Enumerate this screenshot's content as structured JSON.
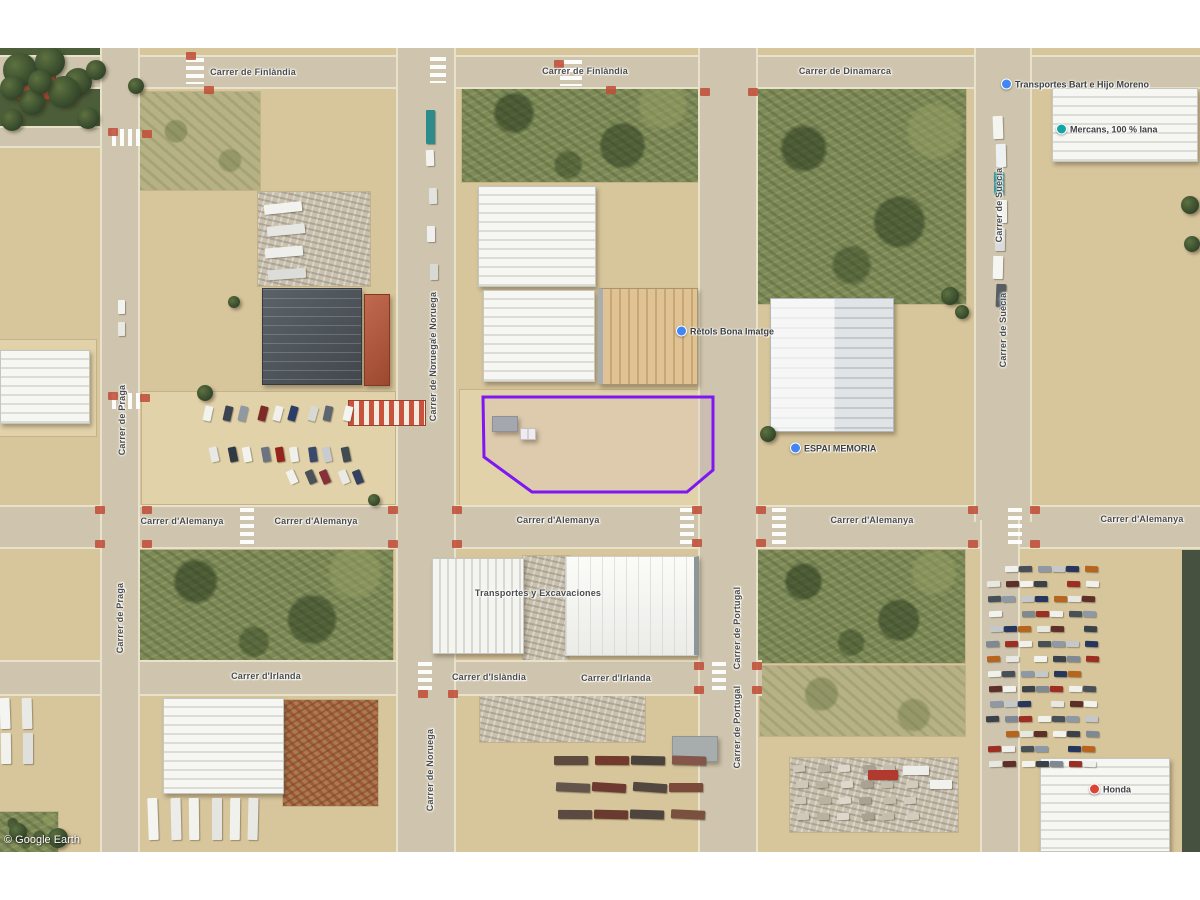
{
  "meta": {
    "watermark": "© Google Earth"
  },
  "map": {
    "x": 0,
    "y": 48,
    "w": 1200,
    "h": 804,
    "letterbox_color": "#ffffff",
    "base_color": "#d7c59c"
  },
  "parcel": {
    "stroke": "#7e17f2",
    "fill": "rgba(126,23,242,0.04)",
    "points": [
      [
        483,
        397
      ],
      [
        713,
        397
      ],
      [
        713,
        470
      ],
      [
        687,
        492
      ],
      [
        532,
        492
      ],
      [
        484,
        457
      ]
    ]
  },
  "terrain": [
    {
      "kind": "treesbed",
      "x": 0,
      "y": 48,
      "w": 104,
      "h": 92
    },
    {
      "kind": "scrublight",
      "x": 140,
      "y": 92,
      "w": 120,
      "h": 98
    },
    {
      "kind": "scrub",
      "x": 462,
      "y": 86,
      "w": 236,
      "h": 96
    },
    {
      "kind": "scrub",
      "x": 758,
      "y": 88,
      "w": 208,
      "h": 216
    },
    {
      "kind": "scrub",
      "x": 140,
      "y": 550,
      "w": 253,
      "h": 112
    },
    {
      "kind": "scrub",
      "x": 758,
      "y": 550,
      "w": 207,
      "h": 113
    },
    {
      "kind": "scrublight",
      "x": 760,
      "y": 666,
      "w": 205,
      "h": 70
    },
    {
      "kind": "pale",
      "x": 142,
      "y": 392,
      "w": 253,
      "h": 112
    },
    {
      "kind": "pale",
      "x": 460,
      "y": 390,
      "w": 262,
      "h": 116
    },
    {
      "kind": "pale",
      "x": 0,
      "y": 340,
      "w": 96,
      "h": 96
    },
    {
      "kind": "darkstrip",
      "x": 1182,
      "y": 550,
      "w": 18,
      "h": 302
    },
    {
      "kind": "scrub",
      "x": 0,
      "y": 812,
      "w": 58,
      "h": 40
    },
    {
      "kind": "clutter",
      "x": 480,
      "y": 690,
      "w": 165,
      "h": 52
    },
    {
      "kind": "clutter",
      "x": 790,
      "y": 758,
      "w": 168,
      "h": 74
    },
    {
      "kind": "rust",
      "x": 283,
      "y": 700,
      "w": 95,
      "h": 106
    },
    {
      "kind": "clutter",
      "x": 523,
      "y": 556,
      "w": 46,
      "h": 104
    },
    {
      "kind": "clutter",
      "x": 258,
      "y": 192,
      "w": 112,
      "h": 94
    }
  ],
  "roads": [
    {
      "x": 0,
      "y": 55,
      "w": 1200,
      "h": 34
    },
    {
      "x": 0,
      "y": 505,
      "w": 1200,
      "h": 44
    },
    {
      "x": 0,
      "y": 660,
      "w": 762,
      "h": 36
    },
    {
      "x": 0,
      "y": 126,
      "w": 140,
      "h": 22
    },
    {
      "x": 100,
      "y": 48,
      "w": 40,
      "h": 804
    },
    {
      "x": 396,
      "y": 48,
      "w": 60,
      "h": 804
    },
    {
      "x": 698,
      "y": 48,
      "w": 60,
      "h": 804
    },
    {
      "x": 974,
      "y": 48,
      "w": 58,
      "h": 474
    },
    {
      "x": 980,
      "y": 520,
      "w": 40,
      "h": 332
    }
  ],
  "crosswalks": [
    {
      "x": 186,
      "y": 58,
      "w": 18,
      "h": 26,
      "dir": "v"
    },
    {
      "x": 560,
      "y": 60,
      "w": 22,
      "h": 26,
      "dir": "v"
    },
    {
      "x": 430,
      "y": 57,
      "w": 16,
      "h": 26,
      "dir": "v"
    },
    {
      "x": 112,
      "y": 129,
      "w": 30,
      "h": 17,
      "dir": "h"
    },
    {
      "x": 112,
      "y": 393,
      "w": 30,
      "h": 16,
      "dir": "h"
    },
    {
      "x": 240,
      "y": 508,
      "w": 14,
      "h": 38,
      "dir": "v"
    },
    {
      "x": 680,
      "y": 508,
      "w": 14,
      "h": 38,
      "dir": "v"
    },
    {
      "x": 772,
      "y": 508,
      "w": 14,
      "h": 38,
      "dir": "v"
    },
    {
      "x": 1008,
      "y": 508,
      "w": 14,
      "h": 38,
      "dir": "v"
    },
    {
      "x": 418,
      "y": 662,
      "w": 14,
      "h": 32,
      "dir": "v"
    },
    {
      "x": 712,
      "y": 662,
      "w": 14,
      "h": 32,
      "dir": "v"
    }
  ],
  "barrier": {
    "x": 348,
    "y": 400,
    "w": 78,
    "h": 26
  },
  "ramps": [
    [
      95,
      506
    ],
    [
      95,
      540
    ],
    [
      142,
      506
    ],
    [
      142,
      540
    ],
    [
      388,
      506
    ],
    [
      388,
      540
    ],
    [
      452,
      506
    ],
    [
      452,
      540
    ],
    [
      692,
      506
    ],
    [
      692,
      539
    ],
    [
      756,
      506
    ],
    [
      756,
      539
    ],
    [
      968,
      506
    ],
    [
      968,
      540
    ],
    [
      1030,
      506
    ],
    [
      1030,
      540
    ],
    [
      694,
      662
    ],
    [
      694,
      686
    ],
    [
      752,
      662
    ],
    [
      752,
      686
    ],
    [
      418,
      690
    ],
    [
      448,
      690
    ],
    [
      108,
      128
    ],
    [
      142,
      130
    ],
    [
      108,
      392
    ],
    [
      140,
      394
    ],
    [
      186,
      52
    ],
    [
      204,
      86
    ],
    [
      554,
      60
    ],
    [
      606,
      86
    ],
    [
      700,
      88
    ],
    [
      748,
      88
    ]
  ],
  "buildings": [
    {
      "name": "house-red-roof",
      "x": 16,
      "y": 62,
      "w": 40,
      "h": 38,
      "style": "red-roof"
    },
    {
      "name": "warehouse",
      "x": 0,
      "y": 350,
      "w": 90,
      "h": 74,
      "style": "white-h"
    },
    {
      "name": "warehouse-dark",
      "x": 262,
      "y": 288,
      "w": 100,
      "h": 97,
      "style": "dark"
    },
    {
      "name": "building-red",
      "x": 364,
      "y": 294,
      "w": 26,
      "h": 92,
      "style": "red-roof"
    },
    {
      "name": "warehouse",
      "x": 478,
      "y": 186,
      "w": 118,
      "h": 101,
      "style": "white-h"
    },
    {
      "name": "warehouse",
      "x": 483,
      "y": 290,
      "w": 112,
      "h": 92,
      "style": "white-h"
    },
    {
      "name": "warehouse-tan",
      "x": 598,
      "y": 288,
      "w": 100,
      "h": 97,
      "style": "tan-v"
    },
    {
      "name": "warehouse-two-tone",
      "x": 770,
      "y": 298,
      "w": 124,
      "h": 134,
      "style": "two-tone"
    },
    {
      "name": "warehouse",
      "x": 1052,
      "y": 88,
      "w": 146,
      "h": 74,
      "style": "white-h"
    },
    {
      "name": "warehouse",
      "x": 432,
      "y": 558,
      "w": 92,
      "h": 96,
      "style": "white-v"
    },
    {
      "name": "warehouse-bright",
      "x": 565,
      "y": 556,
      "w": 134,
      "h": 100,
      "style": "white-bright"
    },
    {
      "name": "warehouse",
      "x": 163,
      "y": 698,
      "w": 121,
      "h": 96,
      "style": "white-h"
    },
    {
      "name": "warehouse",
      "x": 1040,
      "y": 758,
      "w": 130,
      "h": 94,
      "style": "white-h"
    },
    {
      "name": "shed-gray",
      "x": 672,
      "y": 736,
      "w": 46,
      "h": 26,
      "style": "gray"
    },
    {
      "name": "shed-gray",
      "x": 492,
      "y": 416,
      "w": 26,
      "h": 16,
      "style": "gray"
    },
    {
      "name": "shed",
      "x": 520,
      "y": 428,
      "w": 16,
      "h": 12,
      "style": "white-v"
    }
  ],
  "vehicle_clusters": [
    {
      "name": "parked-cars-row-a",
      "x": 206,
      "y": 406,
      "cols": 9,
      "rows": 1,
      "dx": 17,
      "dy": 0,
      "w": 8,
      "h": 15,
      "rot": 14,
      "palette": [
        "#f2f2ef",
        "#3c4450",
        "#8f99a4",
        "#7d2b24",
        "#f0f0ec",
        "#2c3e66",
        "#d8d8d4",
        "#5d666f",
        "#f4f4f0"
      ]
    },
    {
      "name": "parked-cars-row-b",
      "x": 212,
      "y": 447,
      "cols": 9,
      "rows": 1,
      "dx": 16,
      "dy": 0,
      "w": 8,
      "h": 15,
      "rot": -10,
      "palette": [
        "#e8e8e4",
        "#2f3a45",
        "#f2f2ee",
        "#6b7480",
        "#93231c",
        "#f0f0ea",
        "#39486b",
        "#c9ccce",
        "#424a52"
      ]
    },
    {
      "name": "parked-cars-row-c",
      "x": 290,
      "y": 470,
      "cols": 5,
      "rows": 1,
      "dx": 16,
      "dy": 3,
      "w": 8,
      "h": 14,
      "rot": -22,
      "palette": [
        "#f1f1ed",
        "#4a5258",
        "#86303a",
        "#e9e9e5",
        "#33415f"
      ]
    },
    {
      "name": "car-depot",
      "x": 988,
      "y": 566,
      "cols": 7,
      "rows": 14,
      "dx": 16,
      "dy": 15,
      "w": 13,
      "h": 6,
      "rot": 0,
      "palette": [
        "#9c2e24",
        "#f0f0ec",
        "#474f57",
        "#8d99a6",
        "#c4c8cb",
        "#27365c",
        "#b5651d",
        "#e8e8e3",
        "#5d2f28",
        "#f2f2ef",
        "#3a4149",
        "#7e8994"
      ]
    },
    {
      "name": "trucks-street",
      "x": 995,
      "y": 116,
      "cols": 1,
      "rows": 7,
      "dx": 0,
      "dy": 28,
      "w": 10,
      "h": 23,
      "rot": 0,
      "palette": [
        "#f4f4f1",
        "#eef1f2",
        "#2f8f8f",
        "#f1f1ee",
        "#d9dbdc",
        "#f5f5f2",
        "#565e64"
      ]
    },
    {
      "name": "dark-trucks",
      "x": 556,
      "y": 756,
      "cols": 4,
      "rows": 3,
      "dx": 38,
      "dy": 27,
      "w": 34,
      "h": 9,
      "rot": 2,
      "palette": [
        "#5f4a40",
        "#73392c",
        "#4a433c",
        "#84564a",
        "#64554c",
        "#6e392f",
        "#53483f",
        "#7c4a3a",
        "#5a4a42",
        "#6b3a2f",
        "#4e453e",
        "#7a503e"
      ]
    },
    {
      "name": "white-trailers-left",
      "x": 2,
      "y": 698,
      "cols": 2,
      "rows": 2,
      "dx": 19,
      "dy": 35,
      "w": 10,
      "h": 31,
      "rot": 0,
      "palette": [
        "#f4f4f2",
        "#e9e9e6",
        "#f1f1ee",
        "#dfe0de"
      ]
    },
    {
      "name": "white-trailers-row",
      "x": 150,
      "y": 798,
      "cols": 6,
      "rows": 1,
      "dx": 20,
      "dy": 0,
      "w": 10,
      "h": 42,
      "rot": 0,
      "palette": [
        "#f4f4f1",
        "#ececea",
        "#f2f2ef",
        "#e4e4e0",
        "#f0f0ed",
        "#e8e8e5"
      ]
    },
    {
      "name": "scrap-trucks",
      "x": 266,
      "y": 203,
      "cols": 1,
      "rows": 4,
      "dx": 0,
      "dy": 22,
      "w": 38,
      "h": 10,
      "rot": -4,
      "palette": [
        "#f2f2ee",
        "#e6e6e2",
        "#eeeeea",
        "#dcdcd8"
      ]
    },
    {
      "name": "street-cars",
      "x": 428,
      "y": 150,
      "cols": 1,
      "rows": 4,
      "dx": 0,
      "dy": 38,
      "w": 8,
      "h": 16,
      "rot": 0,
      "palette": [
        "#f2f2ef",
        "#e2e2de",
        "#eef0f0",
        "#d8d8d4"
      ]
    },
    {
      "name": "pallets",
      "x": 795,
      "y": 765,
      "cols": 6,
      "rows": 4,
      "dx": 22,
      "dy": 16,
      "w": 12,
      "h": 7,
      "rot": -3,
      "palette": [
        "#cfc9bb",
        "#b9b2a2",
        "#ddd8cb",
        "#a9a294",
        "#c5beae",
        "#d2ccbf"
      ]
    }
  ],
  "vehicles_extra": [
    {
      "x": 868,
      "y": 770,
      "w": 30,
      "h": 10,
      "c": "#b03a2e"
    },
    {
      "x": 903,
      "y": 766,
      "w": 26,
      "h": 9,
      "c": "#ededea"
    },
    {
      "x": 930,
      "y": 780,
      "w": 22,
      "h": 9,
      "c": "#f1f1ed"
    },
    {
      "x": 426,
      "y": 110,
      "w": 9,
      "h": 34,
      "c": "#2e8b8b"
    },
    {
      "x": 118,
      "y": 300,
      "w": 7,
      "h": 14,
      "c": "#f2f2ef"
    },
    {
      "x": 118,
      "y": 322,
      "w": 7,
      "h": 14,
      "c": "#e8e8e4"
    }
  ],
  "trees": [
    [
      20,
      70,
      17
    ],
    [
      50,
      62,
      15
    ],
    [
      78,
      82,
      14
    ],
    [
      32,
      102,
      13
    ],
    [
      64,
      92,
      16
    ],
    [
      12,
      120,
      11
    ],
    [
      88,
      118,
      11
    ],
    [
      96,
      70,
      10
    ],
    [
      12,
      88,
      12
    ],
    [
      40,
      82,
      12
    ],
    [
      136,
      86,
      8
    ],
    [
      205,
      393,
      8
    ],
    [
      234,
      302,
      6
    ],
    [
      950,
      296,
      9
    ],
    [
      962,
      312,
      7
    ],
    [
      768,
      434,
      8
    ],
    [
      1190,
      205,
      9
    ],
    [
      1192,
      244,
      8
    ],
    [
      58,
      838,
      10
    ],
    [
      18,
      832,
      9
    ],
    [
      374,
      500,
      6
    ]
  ],
  "street_labels": [
    {
      "text": "Carrer de Finlàndia",
      "x": 253,
      "y": 72
    },
    {
      "text": "Carrer de Finlàndia",
      "x": 585,
      "y": 71
    },
    {
      "text": "Carrer de Dinamarca",
      "x": 845,
      "y": 71
    },
    {
      "text": "Carrer d'Alemanya",
      "x": 182,
      "y": 521
    },
    {
      "text": "Carrer d'Alemanya",
      "x": 316,
      "y": 521
    },
    {
      "text": "Carrer d'Alemanya",
      "x": 558,
      "y": 520
    },
    {
      "text": "Carrer d'Alemanya",
      "x": 872,
      "y": 520
    },
    {
      "text": "Carrer d'Alemanya",
      "x": 1142,
      "y": 519
    },
    {
      "text": "Carrer d'Irlanda",
      "x": 266,
      "y": 676
    },
    {
      "text": "Carrer d'Islàndia",
      "x": 489,
      "y": 677
    },
    {
      "text": "Carrer d'Irlanda",
      "x": 616,
      "y": 678
    },
    {
      "text": "Transportes y Excavaciones",
      "x": 538,
      "y": 593
    },
    {
      "text": "Carrer de Praga",
      "x": 122,
      "y": 420,
      "vert": true
    },
    {
      "text": "Carrer de Praga",
      "x": 120,
      "y": 618,
      "vert": true
    },
    {
      "text": "Carrer de Noruega",
      "x": 433,
      "y": 333,
      "vert": true
    },
    {
      "text": "Carrer de Noruega",
      "x": 433,
      "y": 380,
      "vert": true
    },
    {
      "text": "Carrer de Noruega",
      "x": 430,
      "y": 770,
      "vert": true
    },
    {
      "text": "Carrer de Portugal",
      "x": 737,
      "y": 628,
      "vert": true
    },
    {
      "text": "Carrer de Portugal",
      "x": 737,
      "y": 727,
      "vert": true
    },
    {
      "text": "Carrer de Suècia",
      "x": 999,
      "y": 205,
      "vert": true
    },
    {
      "text": "Carrer de Suècia",
      "x": 1003,
      "y": 330,
      "vert": true
    }
  ],
  "poi_labels": [
    {
      "text": "Rètols Bona Imatge",
      "x": 688,
      "y": 331,
      "color": "#4285f4"
    },
    {
      "text": "ESPAI MEMORIA",
      "x": 802,
      "y": 448,
      "color": "#4285f4"
    },
    {
      "text": "Transportes Bart e Hijo Moreno",
      "x": 1013,
      "y": 84,
      "color": "#4285f4"
    },
    {
      "text": "Mercans, 100 % lana",
      "x": 1068,
      "y": 129,
      "color": "#12a5a5"
    },
    {
      "text": "Honda",
      "x": 1101,
      "y": 789,
      "color": "#db4437"
    }
  ]
}
